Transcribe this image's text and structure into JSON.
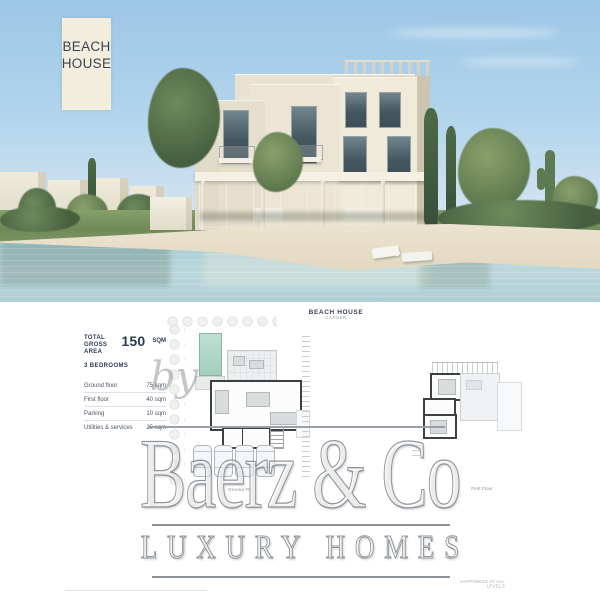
{
  "badge": {
    "line1": "BEACH",
    "line2": "HOUSE"
  },
  "sheet": {
    "title": "BEACH HOUSE",
    "subtitle": "GARDEN",
    "specs": {
      "total_line1": "TOTAL",
      "total_line2": "GROSS AREA",
      "total_value": "150",
      "total_unit": "SQM",
      "bedrooms": "3 BEDROOMS",
      "rows": [
        {
          "label": "Ground floor",
          "value": "75 sqm"
        },
        {
          "label": "First floor",
          "value": "40 sqm"
        },
        {
          "label": "Parking",
          "value": "10 sqm"
        },
        {
          "label": "Utilities & services",
          "value": "25 sqm"
        }
      ]
    },
    "labels": {
      "ground": "Ground Flr.",
      "first": "First Floor"
    },
    "tagline": "HAPPINESS AT ALL LEVELS"
  },
  "watermark": {
    "by": "by",
    "brand": "Baerz & Co",
    "tag": "LUXURY HOMES"
  },
  "colors": {
    "badge_bg": "#f2eddc",
    "ink": "#2f3b52",
    "pool_teal": "#a8d3c4",
    "watermark_gray": "#8f959b",
    "sky": "#a9cfe9",
    "water": "#aed2d8",
    "sand": "#e9e0cc",
    "villa_cream": "#ece5d4",
    "window": "#45575f"
  }
}
